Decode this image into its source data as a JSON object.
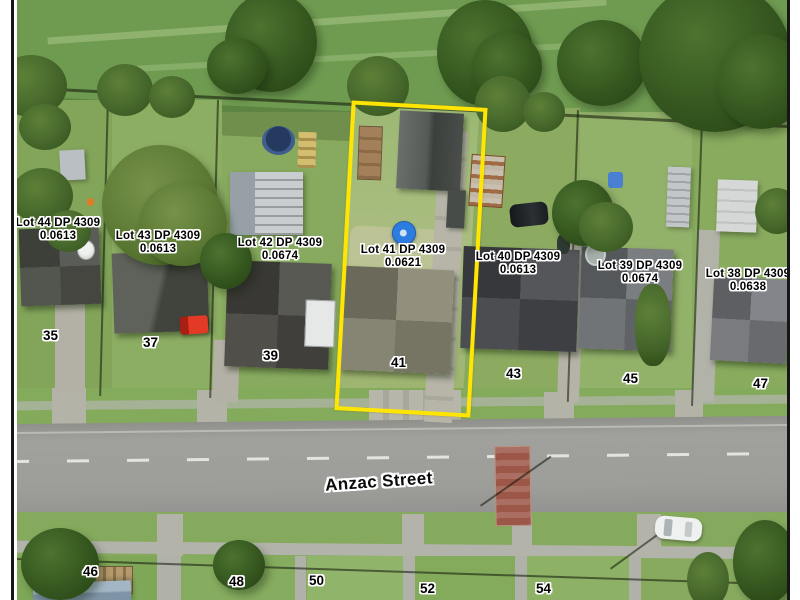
{
  "map": {
    "street": {
      "name": "Anzac Street"
    },
    "lots": [
      {
        "name": "Lot 44 DP 4309",
        "area": "0.0613"
      },
      {
        "name": "Lot 43 DP 4309",
        "area": "0.0613"
      },
      {
        "name": "Lot 42 DP 4309",
        "area": "0.0674"
      },
      {
        "name": "Lot 41 DP 4309",
        "area": "0.0621",
        "highlighted": true
      },
      {
        "name": "Lot 40 DP 4309",
        "area": "0.0613"
      },
      {
        "name": "Lot 39 DP 4309",
        "area": "0.0674"
      },
      {
        "name": "Lot 38 DP 4309",
        "area": "0.0638"
      }
    ],
    "house_numbers": [
      "35",
      "37",
      "39",
      "41",
      "43",
      "45",
      "47",
      "46",
      "48",
      "50",
      "52",
      "54"
    ],
    "colors": {
      "highlight_border": "#FFE602",
      "pin_blue": "#2D7CE0",
      "label_text": "#000000",
      "label_halo": "#FFFFFF",
      "road_grey": "#9D9D99",
      "field_green": "#6F9B51"
    }
  }
}
